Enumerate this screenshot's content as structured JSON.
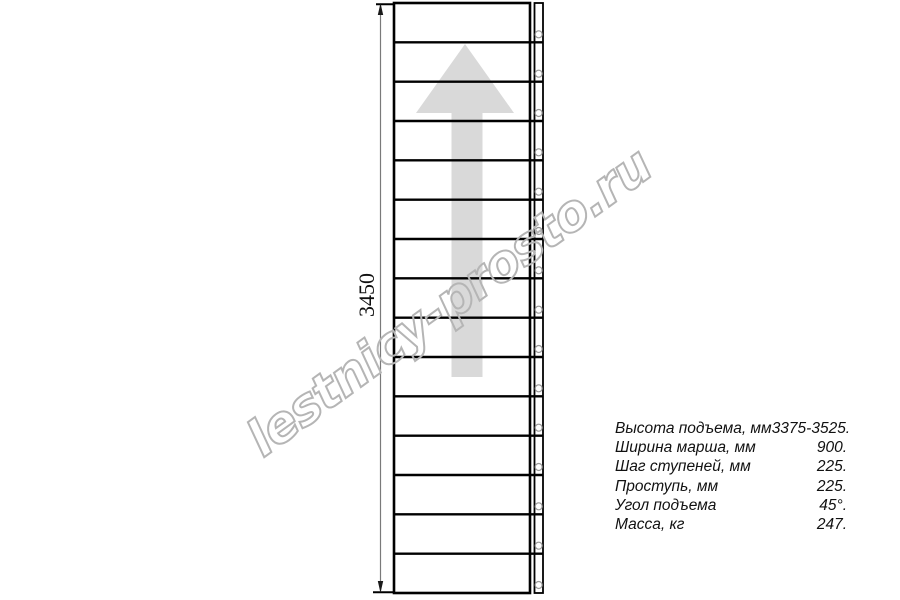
{
  "watermark": {
    "text": "lestnicy-prosto.ru",
    "color": "#b5b5b5"
  },
  "drawing": {
    "type": "staircase-plan-top-view",
    "dimension_label": "3450",
    "steps_count": 15,
    "direction_arrow": "up-arrow",
    "colors": {
      "outline": "#000000",
      "arrow_fill": "#d9d9d9",
      "post_stroke": "#999999",
      "dimension_line": "#7a7a7a",
      "dimension_arrow": "#1a1a1a",
      "step_fill": "#ffffff"
    }
  },
  "specs": {
    "rows": [
      {
        "label": "Высота подъема, мм",
        "value": "3375-3525."
      },
      {
        "label": "Ширина марша, мм",
        "value": "900."
      },
      {
        "label": "Шаг ступеней, мм",
        "value": "225."
      },
      {
        "label": "Проступь, мм",
        "value": "225."
      },
      {
        "label": "Угол подъема",
        "value": "45°."
      },
      {
        "label": "Масса, кг",
        "value": "247."
      }
    ]
  }
}
